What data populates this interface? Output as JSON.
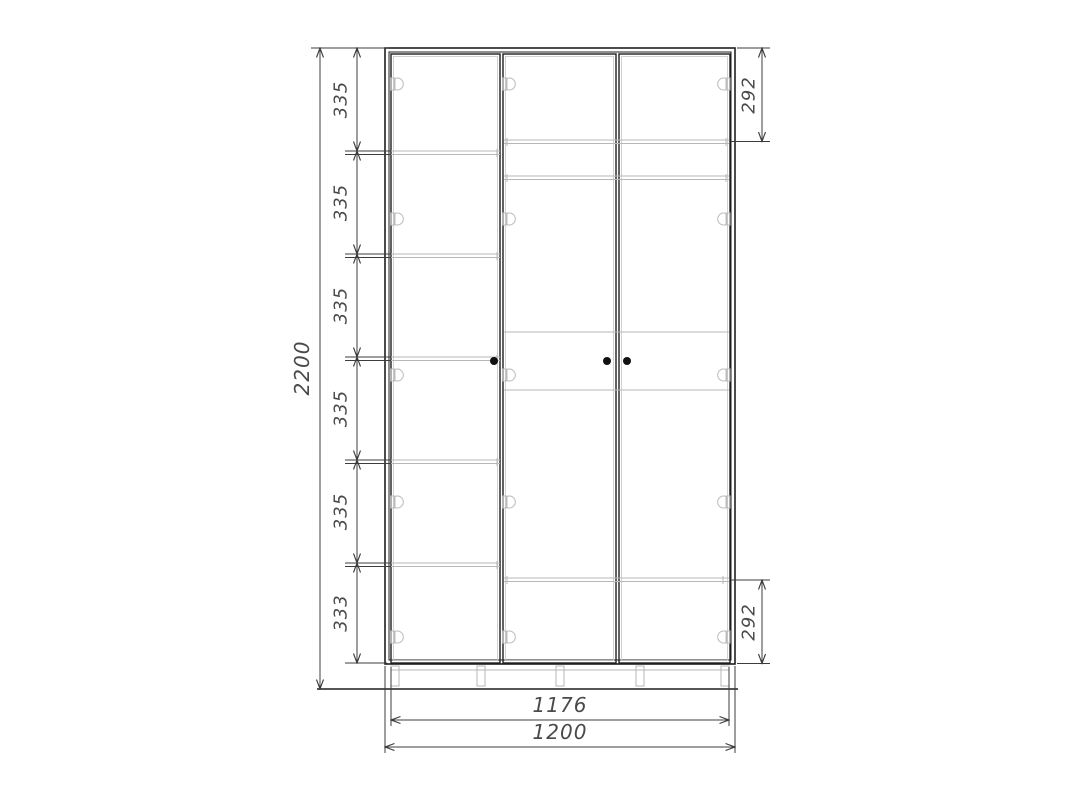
{
  "dims": {
    "overall_height": "2200",
    "chain": [
      "335",
      "335",
      "335",
      "335",
      "335",
      "333"
    ],
    "top_right": "292",
    "bottom_right": "292",
    "doors_width": "1176",
    "overall_width": "1200"
  },
  "colors": {
    "carcass_line": "#1f1f1f",
    "interior_line": "#b7b7b7",
    "dimension_line": "#3c3c3c",
    "dimension_text": "#4a4a4a",
    "background": "#ffffff"
  }
}
